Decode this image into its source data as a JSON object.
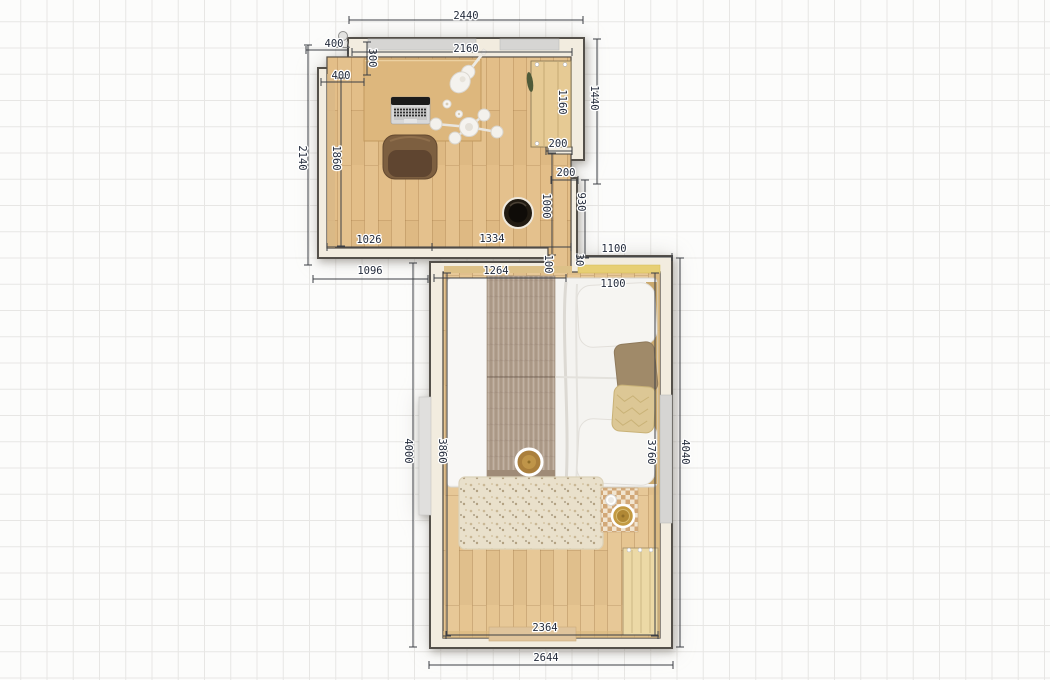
{
  "plan": {
    "colors": {
      "canvas_bg": "#fcfcfb",
      "grid_line": "#e7e6e4",
      "wall_fill": "#f2ecdf",
      "wall_line": "#54504a",
      "dim_line": "#3c3f45",
      "dim_text": "#242c3c",
      "floor_wood": "#e6c591",
      "window_gray": "#d6d5d3",
      "door_wood": "#ecd9a6",
      "bed_white": "#f4f3f0",
      "throw_taupe": "#b5a391",
      "rug_cream": "#e9e0cb",
      "accent_gold": "#c39a42",
      "chair_brown": "#7d5f40",
      "stool_black": "#211b12"
    },
    "dimensions": [
      {
        "label": "2440",
        "x": 466,
        "y": 16,
        "rot": 0,
        "line": [
          349,
          20,
          583,
          20
        ]
      },
      {
        "label": "400",
        "x": 334,
        "y": 44,
        "rot": 0,
        "line": [
          306,
          50,
          348,
          50
        ]
      },
      {
        "label": "300",
        "x": 372,
        "y": 58,
        "rot": 90,
        "line": [
          367,
          42,
          367,
          75
        ]
      },
      {
        "label": "2160",
        "x": 466,
        "y": 49,
        "rot": 0,
        "line": [
          352,
          52,
          572,
          52
        ]
      },
      {
        "label": "400",
        "x": 341,
        "y": 76,
        "rot": 0,
        "line": [
          321,
          82,
          364,
          82
        ]
      },
      {
        "label": "1440",
        "x": 594,
        "y": 98,
        "rot": 90,
        "line": [
          597,
          39,
          597,
          184
        ]
      },
      {
        "label": "1160",
        "x": 562,
        "y": 102,
        "rot": 90
      },
      {
        "label": "2140",
        "x": 302,
        "y": 158,
        "rot": 90,
        "line": [
          308,
          45,
          308,
          265
        ]
      },
      {
        "label": "1860",
        "x": 336,
        "y": 158,
        "rot": 90,
        "line": [
          341,
          78,
          341,
          246
        ]
      },
      {
        "label": "200",
        "x": 558,
        "y": 144,
        "rot": 0,
        "line": [
          546,
          151,
          572,
          151
        ]
      },
      {
        "label": "200",
        "x": 566,
        "y": 173,
        "rot": 0,
        "line": [
          551,
          180,
          578,
          180
        ]
      },
      {
        "label": "930",
        "x": 581,
        "y": 202,
        "rot": 90,
        "line": [
          585,
          180,
          585,
          258
        ]
      },
      {
        "label": "1000",
        "x": 546,
        "y": 206,
        "rot": 90,
        "line": [
          552,
          153,
          552,
          255
        ]
      },
      {
        "label": "1026",
        "x": 369,
        "y": 240,
        "rot": 0,
        "line": [
          327,
          247,
          432,
          247
        ]
      },
      {
        "label": "1334",
        "x": 492,
        "y": 239,
        "rot": 0,
        "line": [
          432,
          247,
          571,
          247
        ]
      },
      {
        "label": "1096",
        "x": 370,
        "y": 271,
        "rot": 0,
        "line": [
          313,
          279,
          428,
          279
        ]
      },
      {
        "label": "100",
        "x": 548,
        "y": 264,
        "rot": 90
      },
      {
        "label": "30",
        "x": 579,
        "y": 260,
        "rot": 90
      },
      {
        "label": "1100",
        "x": 614,
        "y": 249,
        "rot": 0,
        "line": [
          577,
          257,
          672,
          257
        ]
      },
      {
        "label": "1100",
        "x": 613,
        "y": 284,
        "rot": 0
      },
      {
        "label": "1264",
        "x": 496,
        "y": 271,
        "rot": 0,
        "line": [
          434,
          278,
          566,
          278
        ]
      },
      {
        "label": "4000",
        "x": 408,
        "y": 451,
        "rot": 90,
        "line": [
          413,
          263,
          413,
          647
        ]
      },
      {
        "label": "3860",
        "x": 442,
        "y": 451,
        "rot": 90,
        "line": [
          447,
          273,
          447,
          636
        ]
      },
      {
        "label": "3760",
        "x": 651,
        "y": 452,
        "rot": 90,
        "line": [
          655,
          273,
          655,
          636
        ]
      },
      {
        "label": "4040",
        "x": 685,
        "y": 452,
        "rot": 90,
        "line": [
          680,
          258,
          680,
          647
        ]
      },
      {
        "label": "2364",
        "x": 545,
        "y": 628,
        "rot": 0,
        "line": [
          446,
          635,
          658,
          635
        ]
      },
      {
        "label": "2644",
        "x": 546,
        "y": 658,
        "rot": 0,
        "line": [
          429,
          665,
          673,
          665
        ]
      }
    ],
    "icons": [
      "window",
      "wardrobe-door",
      "room-door",
      "ceiling-light",
      "desk",
      "laptop",
      "desk-chair",
      "guitar",
      "flowers",
      "stool",
      "double-bed",
      "throw-blanket",
      "pillow",
      "round-tray",
      "rug",
      "bedside-mat",
      "cup"
    ]
  }
}
